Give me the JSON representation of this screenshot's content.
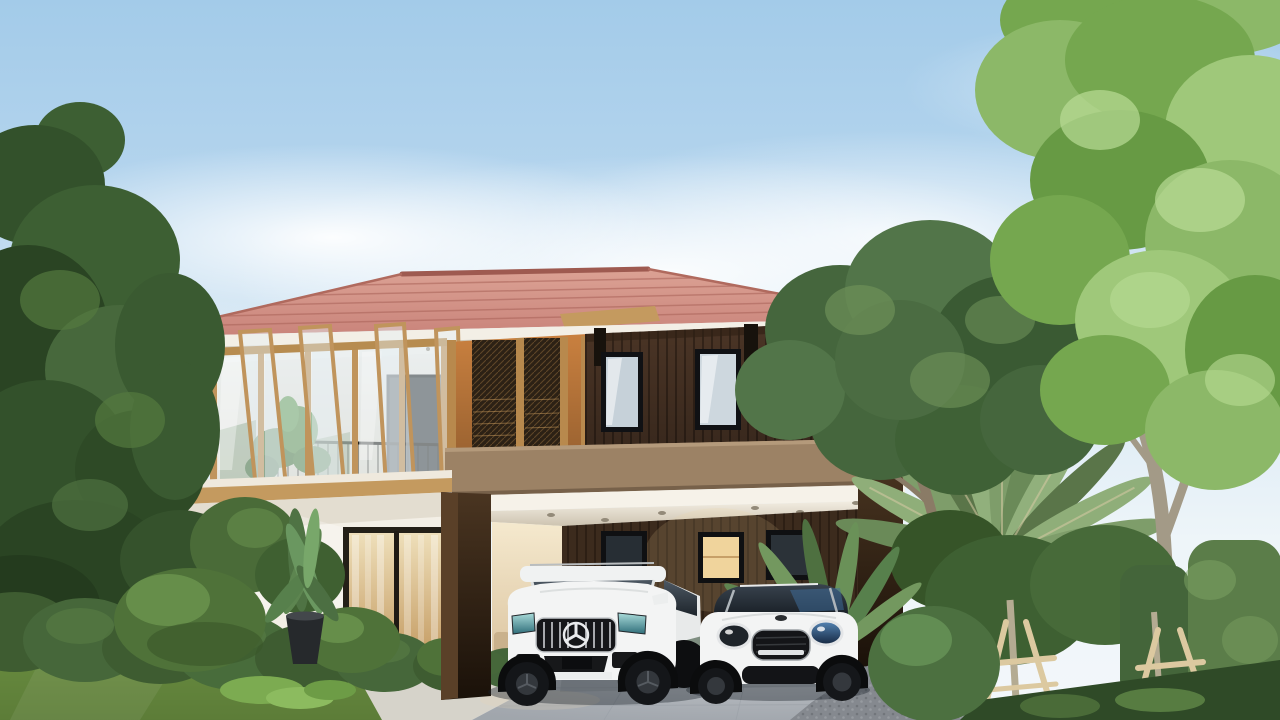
{
  "scene": {
    "type": "architectural-exterior-render",
    "description": "Modern two-storey house with terracotta hip roof, wood-and-glass facade, carport with two white cars and a landscaped tropical garden under a clear day sky",
    "sky": "clear blue sky with soft white clouds",
    "house": {
      "roof": "terracotta tile hip roof with white eave fascia",
      "upper_facade": "golden wood framed glass pivot windows with black balcony railing and plant",
      "screen_wall": "orange wall with dark metal lattice screens",
      "right_facade": "dark timber slat cladding with two black framed windows",
      "balcony_band": "taupe balcony fascia",
      "carport": "double carport, white ceiling with recessed downlights",
      "carport_windows": "three windows on carport back wall, middle one warmly lit",
      "ground_floor": "white wall, black framed window and warm-lit sliding glass door"
    },
    "vehicles": {
      "left": "white Mercedes-AMG SUV with vertical slat grille and star emblem",
      "right": "white MINI Countryman with round headlights and black mesh grille"
    },
    "garden": {
      "left_trees": "tall dark green trees",
      "right_trees": "large light-green maple tree and dark leafy tree",
      "travelers_palm": "fan shaped travelers palm",
      "staked_trees": "young trees with wooden A-frame support stakes",
      "hedges": "trimmed hedge row, topiary balls and tall hedge column",
      "potted_plant": "black pot with banana-leaf plant",
      "lawn": "mowed green lawn",
      "driveway": "light grey concrete paver driveway",
      "gravel": "perforated paver strip"
    }
  },
  "palette": {
    "sky_top": "#a3cbe9",
    "roof_tile": "#c9837a",
    "roof_ridge": "#9e5a50",
    "wood_frame": "#c0945c",
    "orange_wall": "#c9803f",
    "screen_mesh": "#2c2115",
    "slat_wall": "#4b3526",
    "balcony_fascia": "#9c8265",
    "white_wall": "#f3efe6",
    "carport_wall": "#3c2b1d",
    "window_frame": "#101114",
    "lit_window": "#f0d49c",
    "lawn": "#688c3f",
    "hedge": "#5b7d49",
    "topiary": "#4f7239",
    "driveway": "#b7bcc2",
    "tree_dark": "#45663d",
    "tree_light": "#8cb868",
    "trunk": "#a39a87",
    "stake_wood": "#dcc9a0",
    "car_white": "#f3f4f4",
    "pot": "#26292c"
  }
}
